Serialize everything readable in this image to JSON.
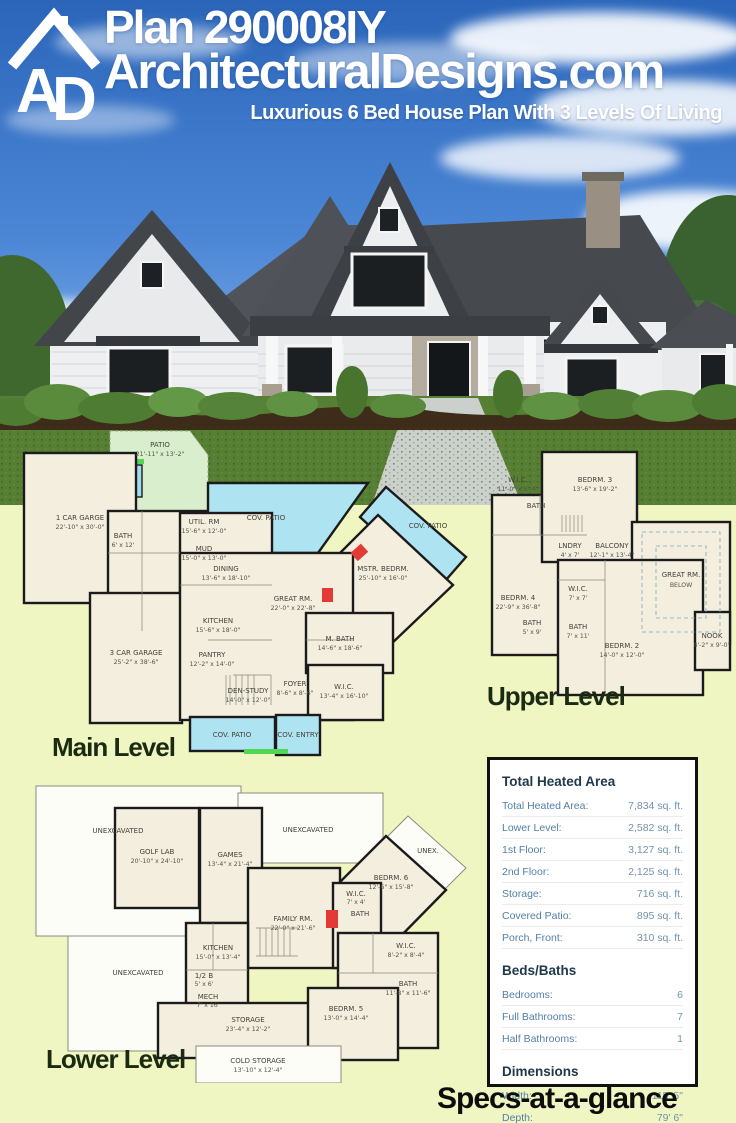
{
  "header": {
    "logo_text": "AD",
    "plan_title": "Plan 290008IY",
    "site_name": "ArchitecturalDesigns.com",
    "tagline": "Luxurious 6 Bed House Plan With 3 Levels Of Living"
  },
  "colors": {
    "sky_blue": "#2f6cc0",
    "lawn_green": "#567f34",
    "page_background": "#eff6c1",
    "plan_paper": "#f3eedd",
    "patio_blue": "#aee3f2",
    "accent_green": "#52d653",
    "accent_red": "#e23a36",
    "spec_heading": "#20394a",
    "spec_text": "#527fa5"
  },
  "plans": {
    "main": {
      "label": "Main Level",
      "rooms": [
        {
          "name": "PATIO",
          "dims": "21'-11\" x 13'-2\""
        },
        {
          "name": "1 CAR GARGE",
          "dims": "22'-10\" x 30'-0\""
        },
        {
          "name": "UTIL. RM",
          "dims": "15'-6\" x 12'-0\""
        },
        {
          "name": "BATH",
          "dims": "6' x 12'"
        },
        {
          "name": "MUD",
          "dims": "15'-0\" x 13'-0\""
        },
        {
          "name": "DINING",
          "dims": "13'-6\" x 18'-10\""
        },
        {
          "name": "COV. PATIO",
          "dims": ""
        },
        {
          "name": "COV. PATIO",
          "dims": ""
        },
        {
          "name": "MSTR. BEDRM.",
          "dims": "25'-10\" x 16'-0\""
        },
        {
          "name": "GREAT RM.",
          "dims": "22'-0\" x 22'-8\""
        },
        {
          "name": "KITCHEN",
          "dims": "15'-6\" x 18'-0\""
        },
        {
          "name": "PANTRY",
          "dims": "12'-2\" x 14'-0\""
        },
        {
          "name": "3 CAR GARAGE",
          "dims": "25'-2\" x 38'-6\""
        },
        {
          "name": "DEN-STUDY",
          "dims": "14'-0\" x 12'-0\""
        },
        {
          "name": "FOYER",
          "dims": "8'-6\" x 8'-6\""
        },
        {
          "name": "W.I.C.",
          "dims": "13'-4\" x 16'-10\""
        },
        {
          "name": "M. BATH",
          "dims": "14'-6\" x 18'-6\""
        },
        {
          "name": "COV. PATIO",
          "dims": ""
        },
        {
          "name": "COV. ENTRY",
          "dims": ""
        }
      ]
    },
    "upper": {
      "label": "Upper Level",
      "rooms": [
        {
          "name": "W.I.C.",
          "dims": "11'-0\" x 6'-4\""
        },
        {
          "name": "BEDRM. 3",
          "dims": "13'-6\" x 19'-2\""
        },
        {
          "name": "BATH",
          "dims": ""
        },
        {
          "name": "LNDRY",
          "dims": "4' x 7'"
        },
        {
          "name": "BALCONY",
          "dims": "12'-1\" x 13'-4\""
        },
        {
          "name": "GREAT RM.",
          "dims": "BELOW"
        },
        {
          "name": "BEDRM. 4",
          "dims": "22'-9\" x 36'-8\""
        },
        {
          "name": "W.I.C.",
          "dims": "7' x 7'"
        },
        {
          "name": "BATH",
          "dims": "5' x 9'"
        },
        {
          "name": "BATH",
          "dims": "7' x 11'"
        },
        {
          "name": "BEDRM. 2",
          "dims": "14'-0\" x 12'-0\""
        },
        {
          "name": "NOOK",
          "dims": "8'-2\" x 9'-0\""
        }
      ]
    },
    "lower": {
      "label": "Lower Level",
      "rooms": [
        {
          "name": "UNEXCAVATED",
          "dims": ""
        },
        {
          "name": "GOLF LAB",
          "dims": "20'-10\" x 24'-10\""
        },
        {
          "name": "GAMES",
          "dims": "13'-4\" x 21'-4\""
        },
        {
          "name": "UNEXCAVATED",
          "dims": ""
        },
        {
          "name": "UNEX.",
          "dims": ""
        },
        {
          "name": "BEDRM. 6",
          "dims": "12'-6\" x 15'-8\""
        },
        {
          "name": "W.I.C.",
          "dims": "7' x 4'"
        },
        {
          "name": "BATH",
          "dims": ""
        },
        {
          "name": "FAMILY RM.",
          "dims": "22'-0\" x 21'-6\""
        },
        {
          "name": "UNEXCAVATED",
          "dims": ""
        },
        {
          "name": "KITCHEN",
          "dims": "15'-0\" x 13'-4\""
        },
        {
          "name": "1/2 B",
          "dims": "5' x 6'"
        },
        {
          "name": "MECH",
          "dims": "7' x 16'"
        },
        {
          "name": "STORAGE",
          "dims": "23'-4\" x 12'-2\""
        },
        {
          "name": "COLD STORAGE",
          "dims": "13'-10\" x 12'-4\""
        },
        {
          "name": "BEDRM. 5",
          "dims": "13'-0\" x 14'-4\""
        },
        {
          "name": "BATH",
          "dims": "11'-8\" x 11'-6\""
        },
        {
          "name": "W.I.C.",
          "dims": "8'-2\" x 8'-4\""
        }
      ]
    }
  },
  "specs": {
    "footer_title": "Specs-at-a-glance",
    "sections": [
      {
        "heading": "Total Heated Area",
        "rows": [
          {
            "label": "Total Heated Area:",
            "value": "7,834 sq. ft."
          },
          {
            "label": "Lower Level:",
            "value": "2,582 sq. ft."
          },
          {
            "label": "1st Floor:",
            "value": "3,127 sq. ft."
          },
          {
            "label": "2nd Floor:",
            "value": "2,125 sq. ft."
          },
          {
            "label": "Storage:",
            "value": "716 sq. ft."
          },
          {
            "label": "Covered Patio:",
            "value": "895 sq. ft."
          },
          {
            "label": "Porch, Front:",
            "value": "310 sq. ft."
          }
        ]
      },
      {
        "heading": "Beds/Baths",
        "rows": [
          {
            "label": "Bedrooms:",
            "value": "6"
          },
          {
            "label": "Full Bathrooms:",
            "value": "7"
          },
          {
            "label": "Half Bathrooms:",
            "value": "1"
          }
        ]
      },
      {
        "heading": "Dimensions",
        "rows": [
          {
            "label": "Width:",
            "value": "115' 5\""
          },
          {
            "label": "Depth:",
            "value": "79' 6\""
          },
          {
            "label": "Max Ridge Height:",
            "value": "34' 6\""
          }
        ]
      }
    ]
  }
}
